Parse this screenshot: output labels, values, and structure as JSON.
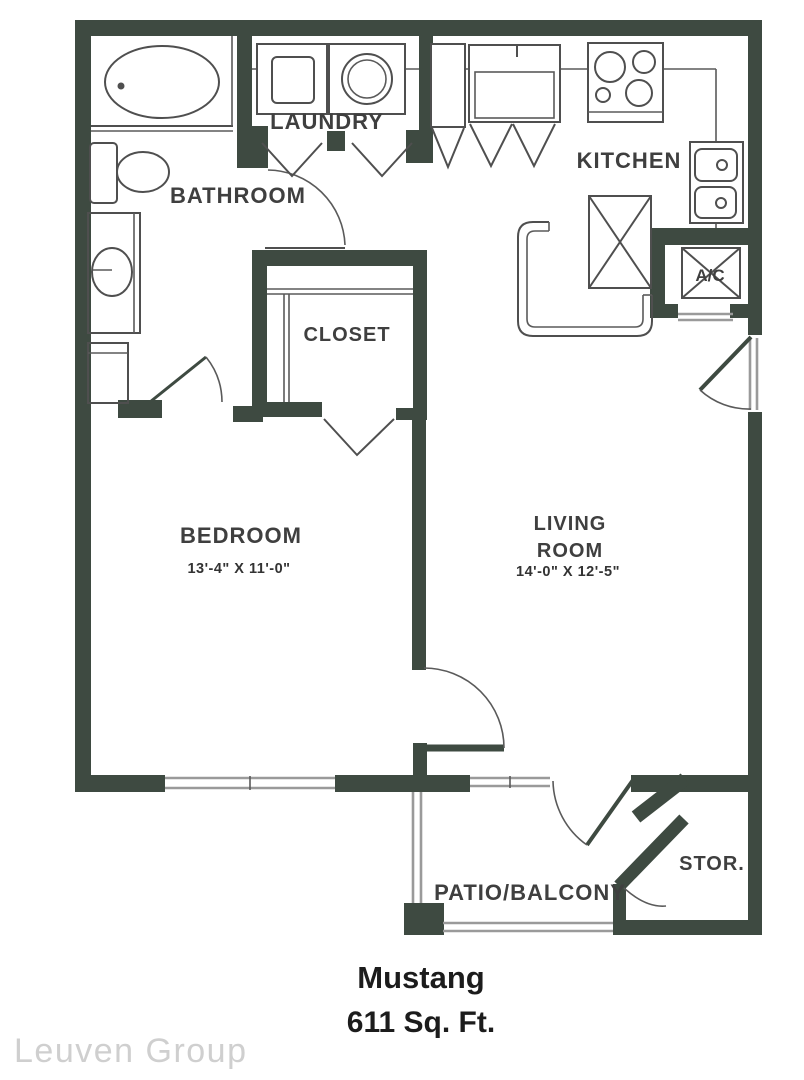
{
  "plan": {
    "rooms": {
      "laundry": "LAUNDRY",
      "bathroom": "BATHROOM",
      "kitchen": "KITCHEN",
      "ac": "A/C",
      "closet": "CLOSET",
      "bedroom": "BEDROOM",
      "bedroom_dims": "13'-4\" X 11'-0\"",
      "living_line1": "LIVING",
      "living_line2": "ROOM",
      "living_dims": "14'-0\" X 12'-5\"",
      "patio": "PATIO/BALCONY",
      "storage": "STOR."
    },
    "footer": {
      "name": "Mustang",
      "area": "611 Sq. Ft."
    },
    "watermark": "Leuven Group",
    "colors": {
      "wall": "#3e4a41",
      "fixture_line": "#4f4f4f",
      "window_line": "#9a9a9a",
      "label_text": "#3f3f3f",
      "title_text": "#1c1c1c",
      "watermark_text": "#cfcfcf"
    }
  }
}
